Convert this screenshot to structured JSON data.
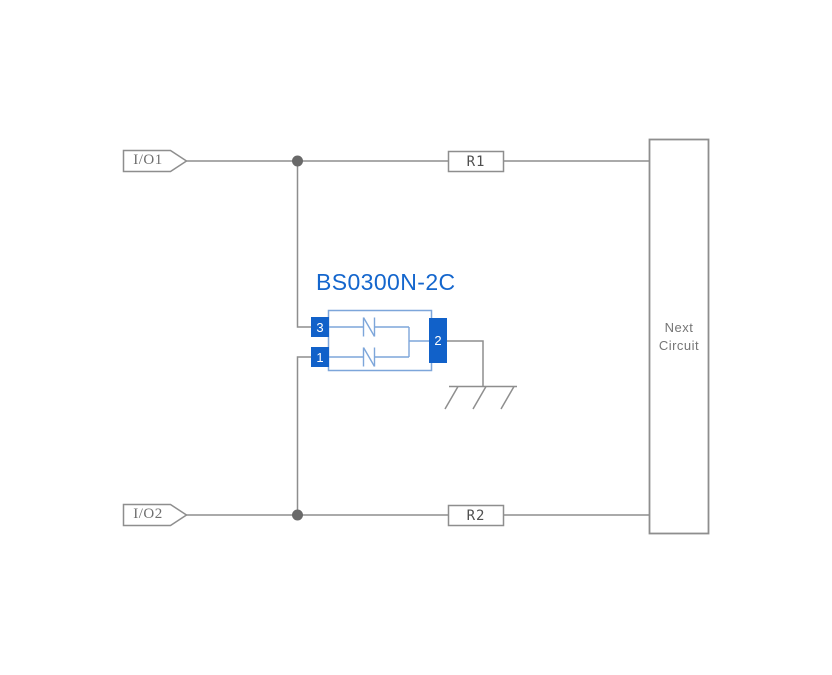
{
  "diagram": {
    "component": {
      "title": "BS0300N-2C",
      "pins": {
        "pin3": "3",
        "pin1": "1",
        "pin2": "2"
      },
      "symbol": "bidirectional-tvs-diode-pair"
    },
    "io_tags": [
      {
        "label": "I/O1"
      },
      {
        "label": "I/O2"
      }
    ],
    "resistors": [
      {
        "label": "R1"
      },
      {
        "label": "R2"
      }
    ],
    "next_circuit": {
      "line1": "Next",
      "line2": "Circuit"
    },
    "ground_symbol": "chassis-ground",
    "colors": {
      "wire_gray": "#8e8e8e",
      "junction_gray": "#696969",
      "pin_blue": "#1161c9",
      "title_blue": "#1466cd",
      "symbol_blue": "#7da6da",
      "label_gray": "#6e6e6e",
      "background": "#ffffff"
    }
  }
}
